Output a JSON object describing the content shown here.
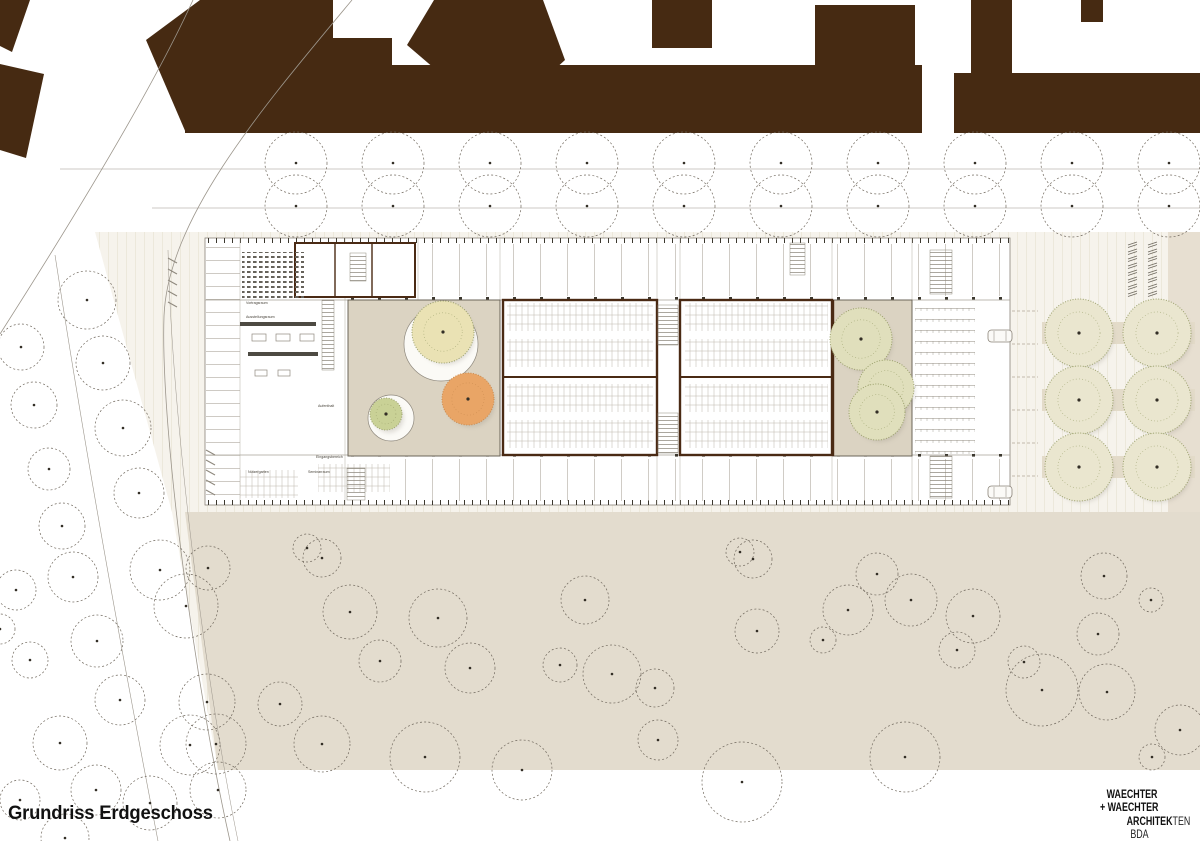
{
  "title": "Grundriss Erdgeschoss",
  "logo_lines": [
    [
      {
        "t": "WAECHTER",
        "b": true
      }
    ],
    [
      {
        "t": "+ WAECHTER",
        "b": true
      }
    ],
    [
      {
        "t": "ARCHITEK",
        "b": true
      },
      {
        "t": "TEN",
        "b": false
      }
    ],
    [
      {
        "t": "BDA",
        "b": false
      }
    ]
  ],
  "plan_labels": [
    {
      "text": "Vortragsraum",
      "x": 246,
      "y": 304
    },
    {
      "text": "Ausstellungsraum",
      "x": 246,
      "y": 318
    },
    {
      "text": "Aufenthalt",
      "x": 318,
      "y": 407
    },
    {
      "text": "Eingangsbereich",
      "x": 316,
      "y": 458
    },
    {
      "text": "Nutzergarten",
      "x": 248,
      "y": 473
    },
    {
      "text": "Seminarraum",
      "x": 308,
      "y": 473
    }
  ],
  "colors": {
    "building_brown": "#462a12",
    "wall_brown": "#4a2a14",
    "plaza_base": "#f6f3ec",
    "plaza_stripe": "#ece8db",
    "beige_field": "#e3dcce",
    "beige_band": "#e7dfd1",
    "courtyard_fill": "#dbd3c2",
    "canopy_yellow": "#eae2b4",
    "canopy_orange": "#e9a566",
    "canopy_green_small": "#c9d196",
    "canopy_green_pale": "#e0dfbc",
    "canopy_grove_pale": "#eae6cf",
    "speckle_green": "#9aa06b",
    "tree_outline": "#6f675c",
    "line_grey": "#9c968c",
    "grid_line": "#bcb6ab",
    "dot_dark": "#332e26",
    "text_black": "#111111"
  },
  "trees": {
    "avenue": {
      "x_start": 296,
      "spacing": 97,
      "count": 10,
      "rows": [
        163,
        206
      ],
      "r": 31
    },
    "roadside": [
      [
        87,
        300,
        29
      ],
      [
        21,
        347,
        23
      ],
      [
        103,
        363,
        27
      ],
      [
        34,
        405,
        23
      ],
      [
        123,
        428,
        28
      ],
      [
        49,
        469,
        21
      ],
      [
        139,
        493,
        25
      ],
      [
        62,
        526,
        23
      ],
      [
        160,
        570,
        30
      ],
      [
        208,
        568,
        22
      ],
      [
        16,
        590,
        20
      ],
      [
        73,
        577,
        25
      ],
      [
        186,
        606,
        32
      ],
      [
        97,
        641,
        26
      ],
      [
        30,
        660,
        18
      ],
      [
        120,
        700,
        25
      ],
      [
        207,
        702,
        28
      ],
      [
        60,
        743,
        27
      ],
      [
        190,
        745,
        30
      ],
      [
        96,
        790,
        25
      ],
      [
        20,
        800,
        20
      ],
      [
        150,
        803,
        27
      ],
      [
        218,
        790,
        28
      ],
      [
        65,
        838,
        24
      ],
      [
        0,
        629,
        15
      ]
    ],
    "field": [
      [
        307,
        548,
        14
      ],
      [
        322,
        558,
        19
      ],
      [
        350,
        612,
        27
      ],
      [
        380,
        661,
        21
      ],
      [
        438,
        618,
        29
      ],
      [
        470,
        668,
        25
      ],
      [
        560,
        665,
        17
      ],
      [
        585,
        600,
        24
      ],
      [
        612,
        674,
        29
      ],
      [
        655,
        688,
        19
      ],
      [
        740,
        552,
        14
      ],
      [
        753,
        559,
        19
      ],
      [
        757,
        631,
        22
      ],
      [
        823,
        640,
        13
      ],
      [
        848,
        610,
        25
      ],
      [
        877,
        574,
        21
      ],
      [
        911,
        600,
        26
      ],
      [
        973,
        616,
        27
      ],
      [
        1024,
        662,
        16
      ],
      [
        1104,
        576,
        23
      ],
      [
        1098,
        634,
        21
      ],
      [
        1151,
        600,
        12
      ],
      [
        216,
        744,
        30
      ],
      [
        280,
        704,
        22
      ],
      [
        322,
        744,
        28
      ],
      [
        425,
        757,
        35
      ],
      [
        522,
        770,
        30
      ],
      [
        658,
        740,
        20
      ],
      [
        742,
        782,
        40
      ],
      [
        905,
        757,
        35
      ],
      [
        957,
        650,
        18
      ],
      [
        1042,
        690,
        36
      ],
      [
        1107,
        692,
        28
      ],
      [
        1152,
        757,
        13
      ],
      [
        1180,
        730,
        25
      ]
    ],
    "grove_grid": {
      "cols": [
        1079,
        1157
      ],
      "rows": [
        333,
        400,
        467
      ],
      "r": 34
    },
    "courtyard_west": [
      {
        "x": 443,
        "y": 332,
        "r": 31,
        "fill": "canopy_yellow",
        "plate": {
          "x": 441,
          "y": 344,
          "r": 37
        }
      },
      {
        "x": 468,
        "y": 399,
        "r": 26,
        "fill": "canopy_orange"
      },
      {
        "x": 386,
        "y": 414,
        "r": 16,
        "fill": "canopy_green_small",
        "plate": {
          "x": 391,
          "y": 418,
          "r": 23
        }
      }
    ],
    "courtyard_east": [
      {
        "x": 861,
        "y": 339,
        "r": 31
      },
      {
        "x": 886,
        "y": 388,
        "r": 28
      },
      {
        "x": 877,
        "y": 412,
        "r": 28
      }
    ]
  },
  "site": {
    "cars": [
      {
        "x": 988,
        "y": 330
      },
      {
        "x": 988,
        "y": 486
      }
    ],
    "bike_racks": {
      "x": 1128,
      "y": 241,
      "rows": 8,
      "cols": 2,
      "dx": 20,
      "dy": 7
    },
    "stall_lines": {
      "x1": 1012,
      "x2": 1038,
      "ys": [
        311,
        344,
        377,
        410,
        443,
        476
      ]
    }
  }
}
